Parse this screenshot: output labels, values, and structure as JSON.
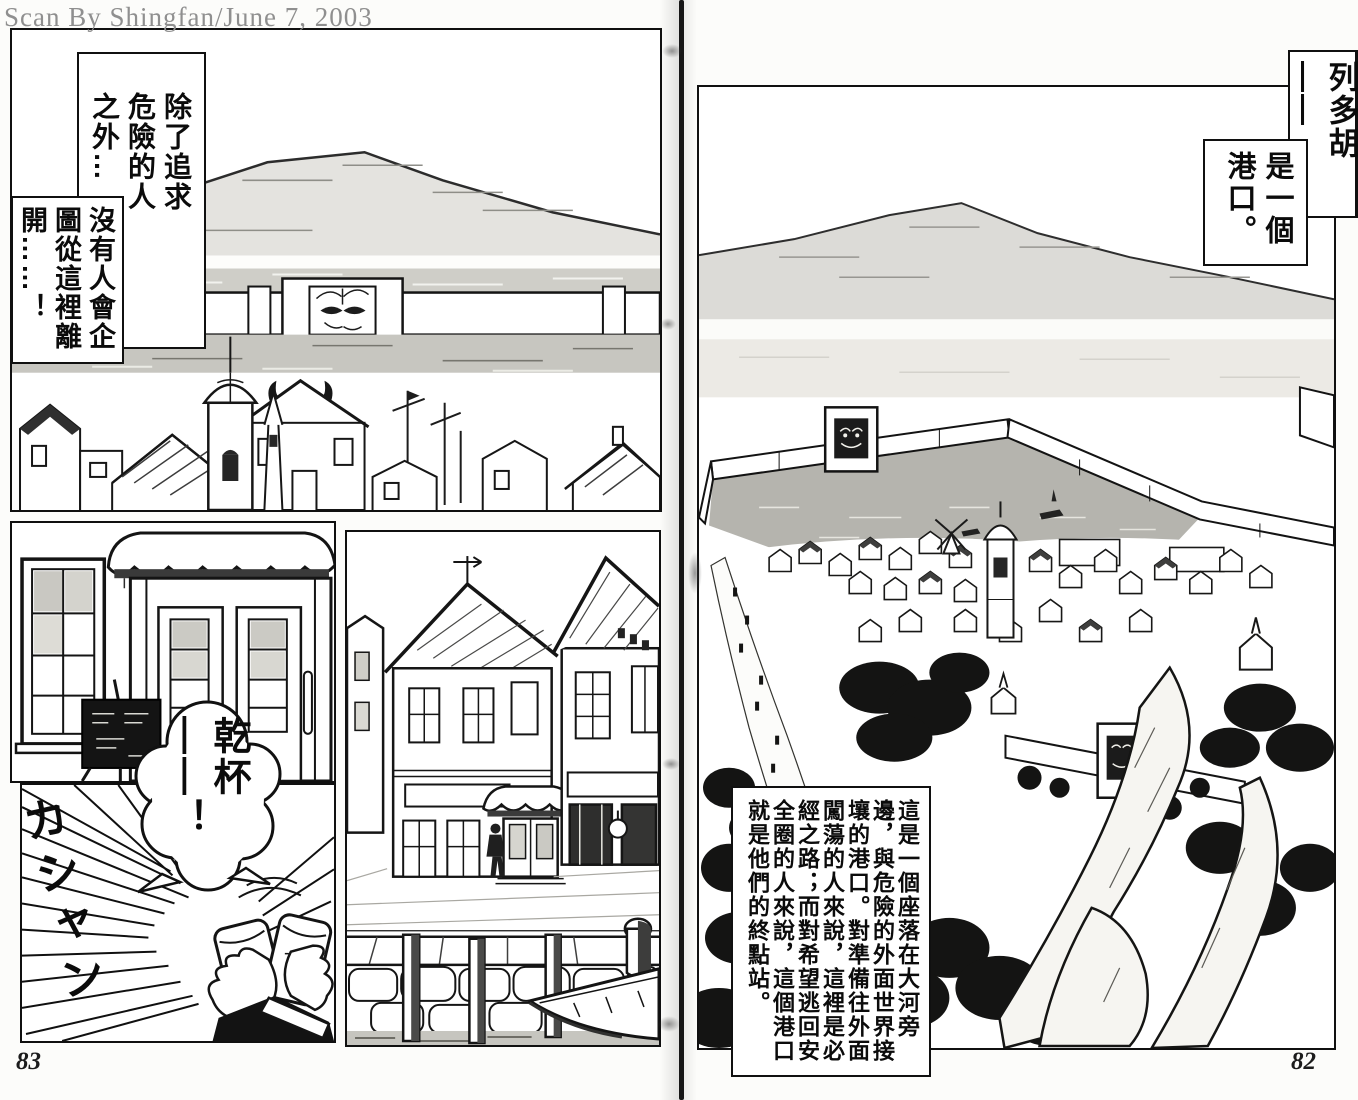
{
  "watermark": "Scan By Shingfan/June 7, 2003",
  "left_page": {
    "page_number": "83",
    "narration_box_1": "除了追求危險的人之外…",
    "narration_box_2": "沒有人會企圖從這裡離開……！",
    "speech_bubble": "乾杯——！",
    "sfx": "カシャン"
  },
  "right_page": {
    "page_number": "82",
    "title_box": "列多胡——",
    "subtitle_box": "是一個港口。",
    "narration_box": "這是一個座落在大河旁邊，與危險的外面世界接壤的港口。對準備往外面闖蕩的人來說，這裡是必經之路；而對希望逃回安全圈的人來說，這個港口就是他們的終點站。"
  },
  "colors": {
    "ink": "#111111",
    "paper": "#fcfcfa",
    "tone_light": "#dcdbd7",
    "tone_mid": "#c7c6c0",
    "water_dark": "#b5b4ae"
  }
}
